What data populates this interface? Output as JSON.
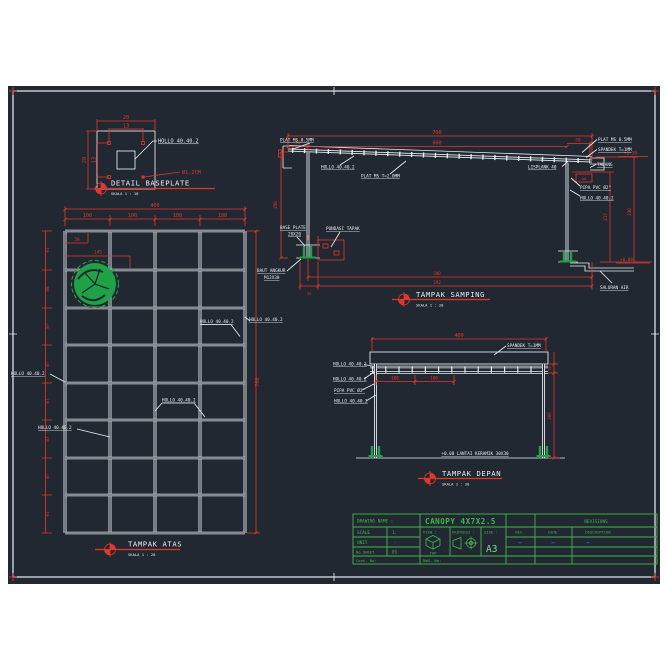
{
  "colors": {
    "background": "#222832",
    "line_white": "#e9edf2",
    "dimension_red": "#e1372b",
    "drawing_green": "#1fa146",
    "titleblock_green": "#43b649",
    "revision_dash_blue": "#4a79e8"
  },
  "baseplate": {
    "title": "DETAIL BASEPLATE",
    "scale": "SKALA 1 : 10",
    "dim_top_outer": "20",
    "dim_top_inner": "13",
    "dim_left_outer": "20",
    "dim_left_inner": "13",
    "hollow_label": "HOLLO 40.40.2",
    "hole_label": "Ø1.2CM"
  },
  "atas": {
    "title": "TAMPAK ATAS",
    "scale": "SKALA 1 : 20",
    "total_width": "400",
    "bays": [
      "100",
      "100",
      "100",
      "100"
    ],
    "total_height": "700",
    "rows": [
      "91",
      "88",
      "87",
      "87",
      "87",
      "87",
      "87",
      "91"
    ],
    "offset_small": "50",
    "offset_tree": "145",
    "hollow_left_1": "HOLLO 40.40.2",
    "hollow_left_2": "HOLLO 40.40.2",
    "hollow_inner_1": "HOLLO 40.40.2",
    "hollow_inner_2": "HOLLO 40.40.2",
    "hollow_right": "HOLLO 40.40.2"
  },
  "samping": {
    "title": "TAMPAK SAMPING",
    "scale": "SKALA 1 : 20",
    "dim_total": "700",
    "dim_span": "600",
    "dim_overhang_left": "50",
    "dim_overhang_right": "50",
    "dim_height_left": "250",
    "dim_height_right_inner": "217",
    "dim_height_right_outer": "230",
    "dim_gutter": "50",
    "dim_base": "35",
    "dim_bottom_1": "300",
    "dim_bottom_2": "392",
    "elev_top": "+2.20",
    "elev_ground": "+0.00",
    "plat_left": "PLAT MS 0.5MM",
    "hollow_roof": "HOLLO 40.40.2",
    "plat_mid": "PLAT MS T=2.0MM",
    "plat_right": "PLAT MS 0.5MM",
    "spandek": "SPANDEK T=1MM",
    "lisplank": "LISPLANK 40",
    "talang": "TALANG",
    "pipa": "PIPA PVC Ø2\"",
    "hollow_col": "HOLLO 40.40.2",
    "base_plate_1": "BASE PLATE",
    "base_plate_2": "20X20",
    "pondasi": "PONDASI TAPAK",
    "angkur_1": "BAUT ANGKUR",
    "angkur_2": "M12X30",
    "saluran": "SALURAN AIR"
  },
  "depan": {
    "title": "TAMPAK DEPAN",
    "scale": "SKALA 1 : 20",
    "dim_total": "400",
    "dim_bay_1": "100",
    "dim_bay_2": "100",
    "dim_band": "33",
    "dim_height": "206",
    "spandek": "SPANDEK T=1MM",
    "hollow_1": "HOLLO 40.40.2",
    "hollow_2": "HOLLO 40.40.2",
    "pipa": "PIPA PVC Ø2\"",
    "hollow_3": "HOLLO 40.40.2",
    "lantai": "+0.00 LANTAI KERAMIK 30X30"
  },
  "titleblock": {
    "drawing_name_label": "DRAWING NAME :",
    "drawing_name": "CANOPY 4X7X2.5",
    "revisions_title": "REVISIONS",
    "scale_label": "SCALE",
    "scale_value": "1:",
    "unit_label": "UNIT",
    "unit_value": "-",
    "sheet_label": "No.SHEET",
    "sheet_value": "01",
    "view_label": "VIEW :",
    "view_value": "TOP",
    "projection_label": "PROYEKSI :",
    "size_label": "SIZE :",
    "size_value": "A3",
    "rev_col": "REV.",
    "date_col": "DATE",
    "desc_col": "DESCRIPTION",
    "dash": "–",
    "cont_label": "Cont. No:",
    "dwg_label": "DWG. No:"
  }
}
